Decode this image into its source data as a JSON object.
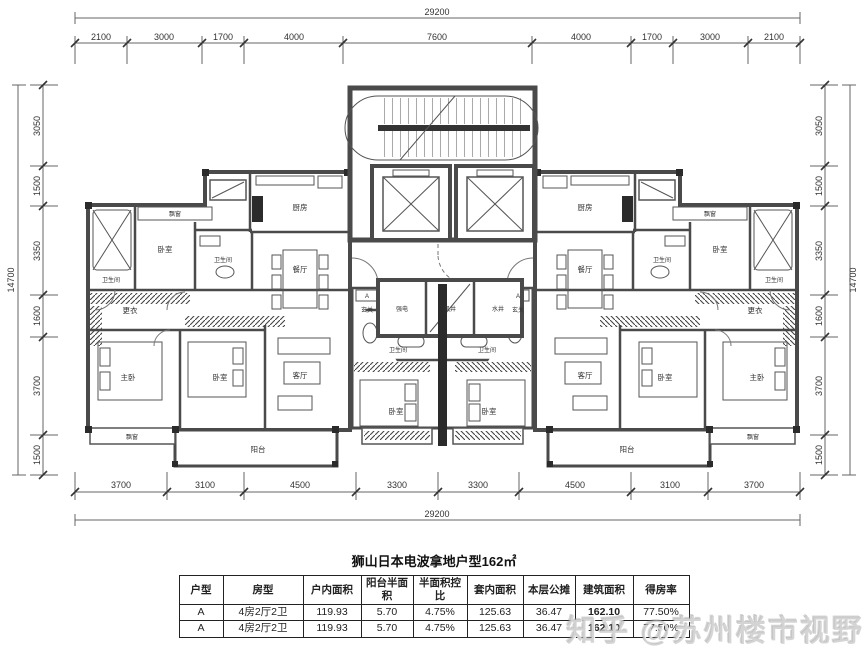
{
  "title": "狮山日本电波拿地户型162㎡",
  "watermark": "知乎 @苏州楼市视野",
  "dims": {
    "top_total": "29200",
    "top": [
      "2100",
      "3000",
      "1700",
      "4000",
      "7600",
      "4000",
      "1700",
      "3000",
      "2100"
    ],
    "bottom": [
      "3700",
      "3100",
      "4500",
      "3300",
      "3300",
      "4500",
      "3100",
      "3700"
    ],
    "bottom_total": "29200",
    "left": [
      "3050",
      "1500",
      "3350",
      "1600",
      "3700",
      "1500"
    ],
    "left_total": "14700",
    "right": [
      "3050",
      "1500",
      "3350",
      "1600",
      "3700",
      "1500"
    ],
    "right_total": "14700"
  },
  "labels": {
    "kitchen": "厨房",
    "dining": "餐厅",
    "living": "客厅",
    "master": "主卧",
    "bedroom": "卧室",
    "bath": "卫生间",
    "dressing": "更衣",
    "balcony": "阳台",
    "bay": "飘窗",
    "entry": "玄关",
    "entry_tag": "A",
    "elec": "强电",
    "wind": "风井",
    "water": "水井"
  },
  "table": {
    "headers": [
      "户型",
      "房型",
      "户内面积",
      "阳台半面积",
      "半面积控比",
      "套内面积",
      "本层公摊",
      "建筑面积",
      "得房率"
    ],
    "rows": [
      [
        "A",
        "4房2厅2卫",
        "119.93",
        "5.70",
        "4.75%",
        "125.63",
        "36.47",
        "162.10",
        "77.50%"
      ],
      [
        "A",
        "4房2厅2卫",
        "119.93",
        "5.70",
        "4.75%",
        "125.63",
        "36.47",
        "162.10",
        "77.50%"
      ]
    ]
  }
}
